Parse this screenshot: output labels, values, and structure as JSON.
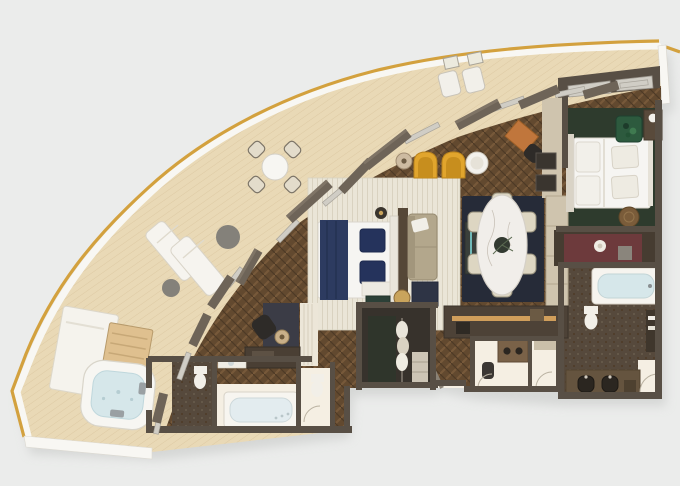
{
  "scene": {
    "title": "Luxury suite floor plan",
    "type": "3d-rendered-floor-plan",
    "view": "top-down"
  },
  "palette": {
    "background": "#ebeceb",
    "shadow": "#c4c6c4",
    "railing_gold": "#d3a13e",
    "railing_white": "#f8f7f3",
    "deck_base": "#e9d9b6",
    "deck_plank_line": "#dcc8a1",
    "wood_base": "#62492f",
    "wood_light": "#77593a",
    "wood_dark": "#4e3a26",
    "wall": "#584f45",
    "window_fin": "#6e6458",
    "window_fin_edge": "#7f7466",
    "glass": "#d0cdc5",
    "rug_cream": "#eae5d7",
    "rug_rib_line": "#d9d2c0",
    "rug_navy": "#262b38",
    "rug_green": "#2e3b2d",
    "mosaic_base": "#56493c",
    "mosaic_dot": "#695c4d",
    "white_floor": "#f5efe3",
    "bed_linen": "#f6f5f2",
    "linen_edge": "#d9d5cc",
    "navy_throw": "#2d3b60",
    "navy_pillow": "#25335c",
    "sofa_taupe": "#b3a78c",
    "chair_yellow": "#e1a52d",
    "chair_yellow_deep": "#c78e1e",
    "marble_white": "#f1eeea",
    "water_blue": "#d6e7ea",
    "cabinet_cream": "#cfc4ae",
    "counter_dark": "#4d4237",
    "warm_light": "#e8ae62",
    "maroon_accent": "#6d3a3c",
    "plant_green": "#2d5a3e",
    "desk_orange": "#c0763c",
    "tv_navy": "#2e3445",
    "teal_cyan": "#7fd8d8",
    "pouf_brown": "#7a5c3a",
    "gray_table": "#84817a",
    "dark_seat": "#2e2b28",
    "tan_lamp": "#c9a45c",
    "study_panel": "#3b3c46",
    "vanity_wood": "#65543f",
    "sink_dark": "#2b2620",
    "door_arc": "#b9b1a0"
  },
  "rooms": {
    "balcony": {
      "label": "Wrap-around balcony"
    },
    "living_lounge": {
      "label": "Living lounge"
    },
    "bedroom_nook": {
      "label": "Second sleeping area"
    },
    "dining_area": {
      "label": "Dining area"
    },
    "study_nook": {
      "label": "Study nook"
    },
    "bar": {
      "label": "Bar / pantry"
    },
    "master_bedroom": {
      "label": "Master bedroom"
    },
    "walk_in_closet": {
      "label": "Walk-in closet"
    },
    "master_bathroom": {
      "label": "Master bathroom"
    },
    "guest_bathroom": {
      "label": "Guest bathroom"
    },
    "powder_room": {
      "label": "Powder room"
    },
    "entry": {
      "label": "Entry vestibule"
    }
  },
  "labels": {
    "hot_tub": "Hot tub",
    "day_bed": "Day bed",
    "towel_shelf": "Towel shelf",
    "sun_loungers": "Sun loungers",
    "outdoor_dining": "Outdoor dining set",
    "deck_chairs": "Deck chairs",
    "double_bed": "Double bed",
    "sofa": "Sofa",
    "armchairs_yellow": "Yellow armchairs",
    "writing_desk": "Writing desk",
    "dining_table": "Dining table",
    "bar_counter": "Bar counter",
    "master_bed": "King bed",
    "wardrobe_dresser": "Dresser",
    "bathtub": "Bathtub",
    "double_vanity": "Double vanity",
    "toilet": "Toilet",
    "study_chair": "Study chair",
    "tv_console": "TV console",
    "side_table": "Side table",
    "floor_lamp": "Floor lamp",
    "plant": "Plant",
    "pouf": "Pouf"
  }
}
